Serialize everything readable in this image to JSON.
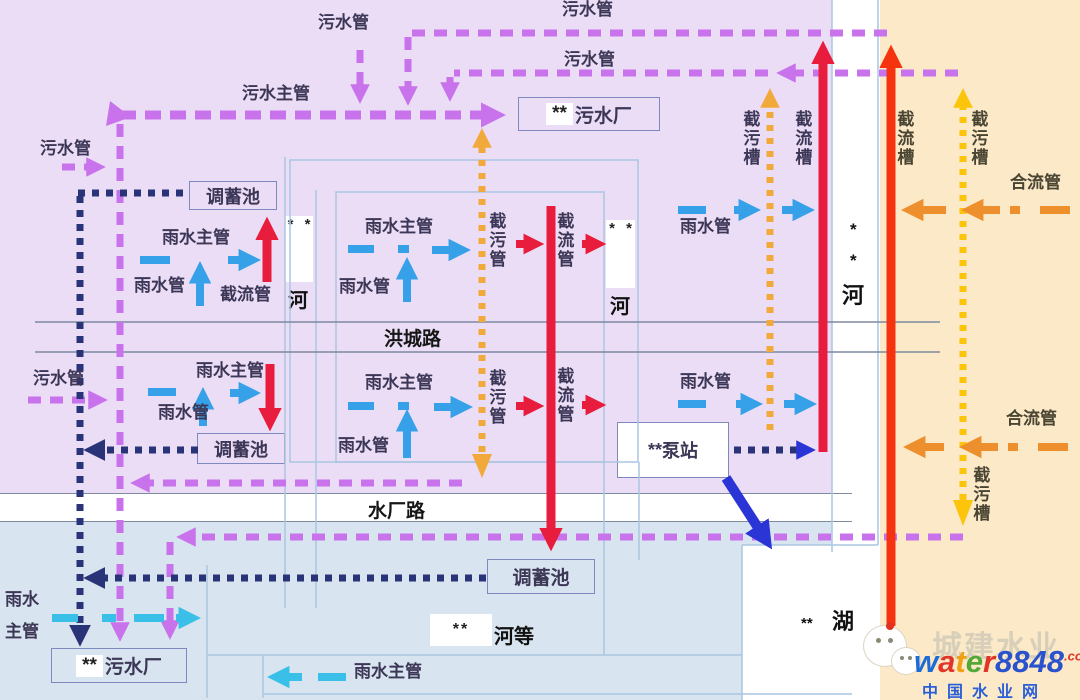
{
  "palette": {
    "purple_bg": "#EBDDF6",
    "beige_bg": "#FBE9C7",
    "blue_bg": "#D8E4EF",
    "white": "#FFFFFF",
    "sewage_pipe": "#C873EC",
    "storage_pipe": "#293377",
    "storm_pipe": "#36A0E8",
    "storm_pipe_light": "#3ABFE8",
    "intercept_red": "#E81C3C",
    "intercept_scarlet": "#F5330F",
    "trough_orange": "#F2A93B",
    "trough_yellow": "#FCC40A",
    "combined_orange": "#EE8F2E",
    "pump_blue": "#2B35D6",
    "road_line": "#7D8AA0",
    "boundary_line": "#AAC6E0"
  },
  "roads": {
    "hongcheng": "洪城路",
    "shuichang": "水厂路"
  },
  "facilities": {
    "tank_top": "调蓄池",
    "tank_mid": "调蓄池",
    "tank_bottom": "调蓄池",
    "wwtp_top": {
      "stars": "**",
      "name": "污水厂"
    },
    "wwtp_bottom": {
      "stars": "**",
      "name": "污水厂"
    },
    "pump": {
      "stars": "**",
      "name": "泵站"
    }
  },
  "water_bodies": {
    "river1": {
      "stars": "* *",
      "name": "河"
    },
    "river2": {
      "stars": "* *",
      "name": "河"
    },
    "main_river": {
      "star1": "*",
      "star2": "*",
      "name": "河"
    },
    "lake": {
      "stars": "**",
      "name": "湖"
    },
    "hedeng": {
      "stars": "**",
      "name": "河等"
    }
  },
  "pipe_labels": [
    {
      "id": "sewage-top-1",
      "t": "污水管",
      "x": 318,
      "y": 14
    },
    {
      "id": "sewage-top-2",
      "t": "污水管",
      "x": 562,
      "y": 1
    },
    {
      "id": "sewage-top-3",
      "t": "污水管",
      "x": 564,
      "y": 51
    },
    {
      "id": "sewage-main",
      "t": "污水主管",
      "x": 242,
      "y": 85
    },
    {
      "id": "sewage-left-1",
      "t": "污水管",
      "x": 40,
      "y": 140
    },
    {
      "id": "storm-main-a1",
      "t": "雨水主管",
      "x": 162,
      "y": 229
    },
    {
      "id": "storm-a1",
      "t": "雨水管",
      "x": 134,
      "y": 277
    },
    {
      "id": "intercept-a1",
      "t": "截流管",
      "x": 220,
      "y": 286
    },
    {
      "id": "storm-main-b1",
      "t": "雨水主管",
      "x": 365,
      "y": 218
    },
    {
      "id": "storm-b1",
      "t": "雨水管",
      "x": 339,
      "y": 278
    },
    {
      "id": "jwg-b1",
      "t": "截污管",
      "x": 486,
      "y": 212,
      "v": 1
    },
    {
      "id": "jlg-b1",
      "t": "截流管",
      "x": 554,
      "y": 212,
      "v": 1
    },
    {
      "id": "storm-c1",
      "t": "雨水管",
      "x": 680,
      "y": 218
    },
    {
      "id": "trough-jw-left",
      "t": "截污槽",
      "x": 740,
      "y": 110,
      "v": 1
    },
    {
      "id": "trough-jl-left",
      "t": "截流槽",
      "x": 792,
      "y": 110,
      "v": 1
    },
    {
      "id": "trough-jl-right",
      "t": "截流槽",
      "x": 894,
      "y": 110,
      "v": 1,
      "c": "beige"
    },
    {
      "id": "trough-jw-right",
      "t": "截污槽",
      "x": 968,
      "y": 110,
      "v": 1,
      "c": "beige"
    },
    {
      "id": "combined-1",
      "t": "合流管",
      "x": 1010,
      "y": 174,
      "c": "beige"
    },
    {
      "id": "sewage-left-2",
      "t": "污水管",
      "x": 33,
      "y": 370
    },
    {
      "id": "storm-main-a2",
      "t": "雨水主管",
      "x": 196,
      "y": 362
    },
    {
      "id": "storm-a2",
      "t": "雨水管",
      "x": 158,
      "y": 404
    },
    {
      "id": "storm-main-b2",
      "t": "雨水主管",
      "x": 365,
      "y": 374
    },
    {
      "id": "storm-b2",
      "t": "雨水管",
      "x": 338,
      "y": 437
    },
    {
      "id": "jwg-b2",
      "t": "截污管",
      "x": 486,
      "y": 369,
      "v": 1
    },
    {
      "id": "jlg-b2",
      "t": "截流管",
      "x": 554,
      "y": 367,
      "v": 1
    },
    {
      "id": "storm-c2",
      "t": "雨水管",
      "x": 680,
      "y": 373
    },
    {
      "id": "combined-2",
      "t": "合流管",
      "x": 1006,
      "y": 410,
      "c": "beige"
    },
    {
      "id": "trough-jw-right-bottom",
      "t": "截污槽",
      "x": 970,
      "y": 466,
      "v": 1,
      "c": "beige"
    },
    {
      "id": "storm-main-bottom",
      "t": "雨水主管",
      "x": 354,
      "y": 663
    },
    {
      "id": "storm-main-left-1",
      "t": "雨水",
      "x": 5,
      "y": 591
    },
    {
      "id": "storm-main-left-2",
      "t": "主管",
      "x": 5,
      "y": 623
    }
  ],
  "watermark": {
    "brand": "城建水业",
    "site_letters": [
      {
        "ch": "w",
        "c": "#1E6BD6"
      },
      {
        "ch": "a",
        "c": "#E23427"
      },
      {
        "ch": "t",
        "c": "#F0A013"
      },
      {
        "ch": "e",
        "c": "#53A838"
      },
      {
        "ch": "r",
        "c": "#E23427"
      },
      {
        "ch": "8",
        "c": "#2A52CC"
      },
      {
        "ch": "8",
        "c": "#2A52CC"
      },
      {
        "ch": "4",
        "c": "#2A52CC"
      },
      {
        "ch": "8",
        "c": "#2A52CC"
      }
    ],
    "site_suffix": ".com",
    "tagline": "中国水业网"
  }
}
